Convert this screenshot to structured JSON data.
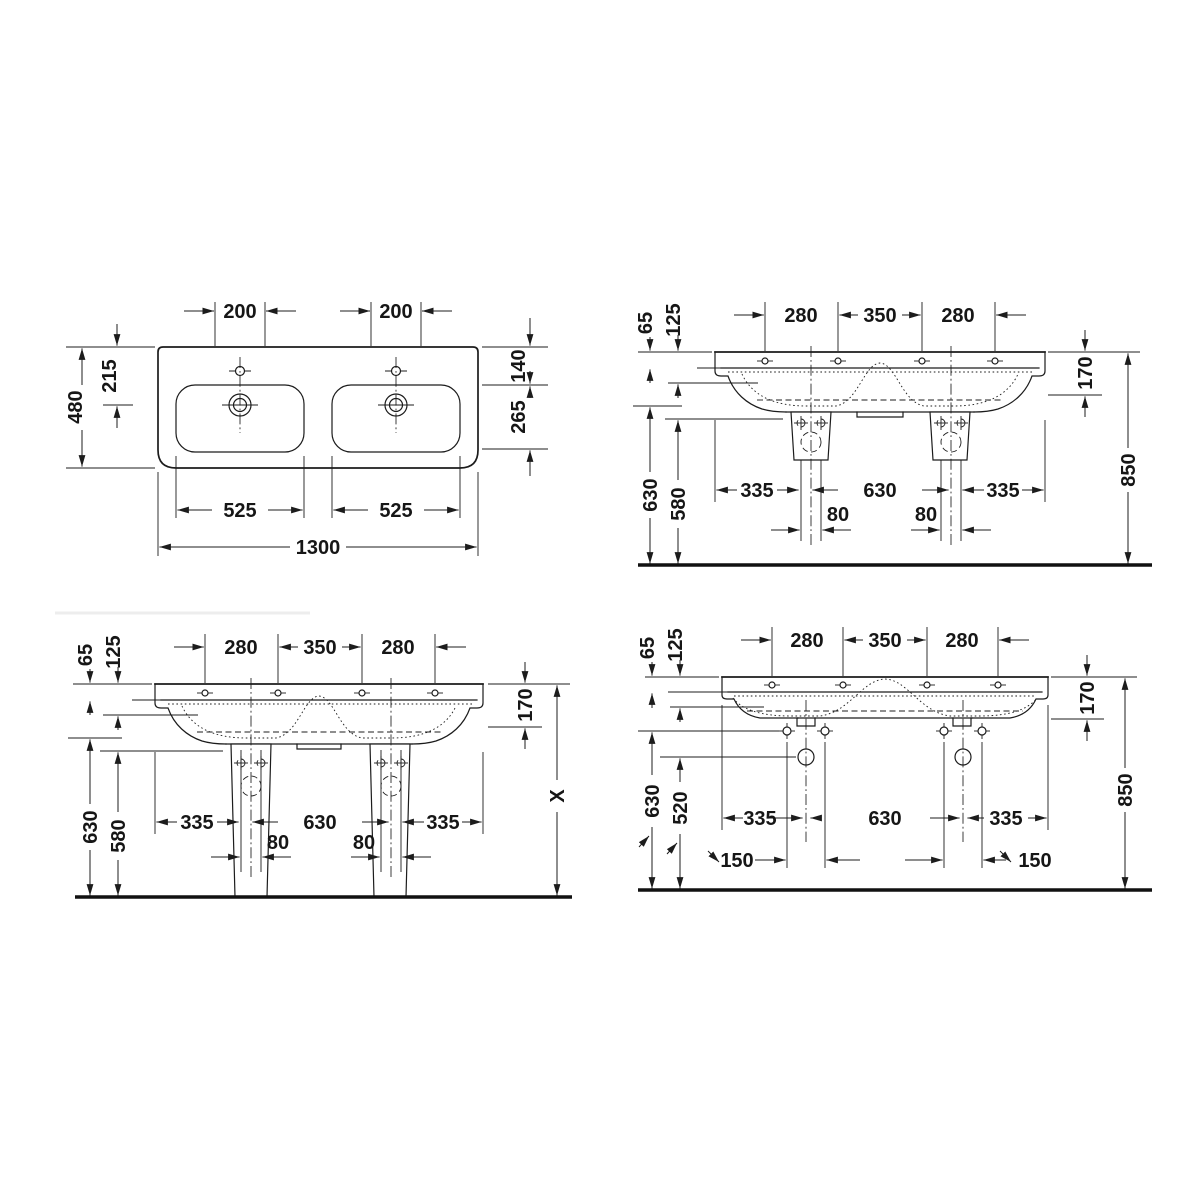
{
  "canvas": {
    "width": 1200,
    "height": 1200,
    "background": "#ffffff",
    "ink": "#1c1c1c"
  },
  "views": {
    "plan": {
      "name": "basin plan view",
      "labels": {
        "tap_left": "200",
        "tap_right": "200",
        "depth": "480",
        "rear_to_drain": "215",
        "rear_to_bowl": "140",
        "bowl_depth": "265",
        "bowl_left": "525",
        "bowl_right": "525",
        "width": "1300"
      }
    },
    "siphon": {
      "name": "front elevation with siphon covers",
      "labels": {
        "rim": "65",
        "front": "125",
        "tap_left": "280",
        "tap_mid": "350",
        "tap_right": "280",
        "underside": "170",
        "height": "850",
        "clear_bowl": "630",
        "clear_apron": "580",
        "side_left": "335",
        "center": "630",
        "side_right": "335",
        "trap_left": "80",
        "trap_right": "80"
      }
    },
    "pedestal": {
      "name": "front elevation with pedestals",
      "labels": {
        "rim": "65",
        "front": "125",
        "tap_left": "280",
        "tap_mid": "350",
        "tap_right": "280",
        "underside": "170",
        "height": "X",
        "clear_bowl": "630",
        "clear_apron": "580",
        "side_left": "335",
        "center": "630",
        "side_right": "335",
        "trap_left": "80",
        "trap_right": "80"
      }
    },
    "wall": {
      "name": "front elevation wall mounted",
      "labels": {
        "rim": "65",
        "front": "125",
        "tap_left": "280",
        "tap_mid": "350",
        "tap_right": "280",
        "underside": "170",
        "height": "850",
        "fix_height": "630",
        "drain_height": "520",
        "side_left": "335",
        "center": "630",
        "side_right": "335",
        "fix_left": "150",
        "fix_right": "150"
      }
    }
  }
}
